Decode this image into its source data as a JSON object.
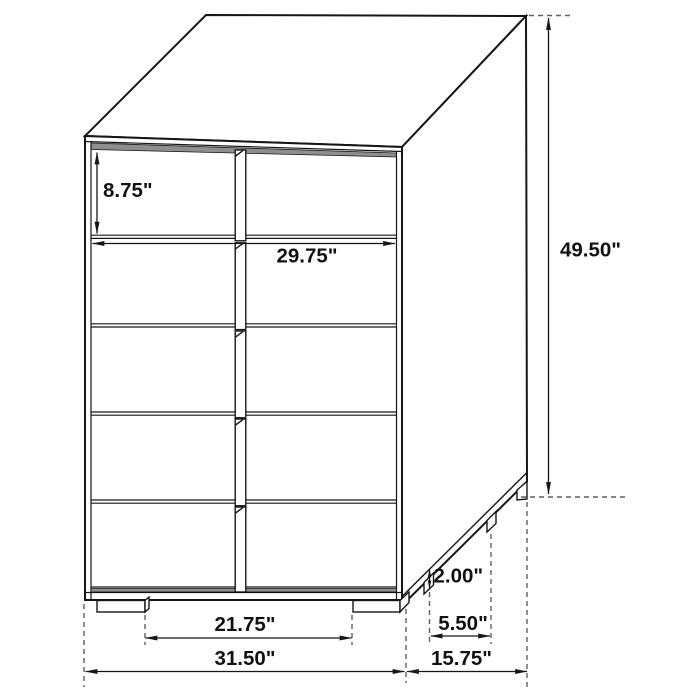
{
  "drawing": {
    "subject": "chest-of-drawers dimensional line drawing",
    "unit": "inches",
    "structure": {
      "drawer_count": 5,
      "front_feet_count": 2,
      "side_feet_count": 3
    },
    "colors": {
      "line": "#161616",
      "dashed_line": "#5f5f5f",
      "shadow_strip": "#8e8e8e",
      "background": "#ffffff",
      "fill": "#ffffff"
    },
    "dimensions": {
      "drawer_height": {
        "value": 8.75,
        "display": "8.75\""
      },
      "drawer_width": {
        "value": 29.75,
        "display": "29.75\""
      },
      "overall_height": {
        "value": 49.5,
        "display": "49.50\""
      },
      "leg_height": {
        "value": 2.0,
        "display": "2.00\""
      },
      "side_leg_gap": {
        "value": 5.5,
        "display": "5.50\""
      },
      "front_leg_gap": {
        "value": 21.75,
        "display": "21.75\""
      },
      "overall_width": {
        "value": 31.5,
        "display": "31.50\""
      },
      "overall_depth": {
        "value": 15.75,
        "display": "15.75\""
      }
    }
  }
}
